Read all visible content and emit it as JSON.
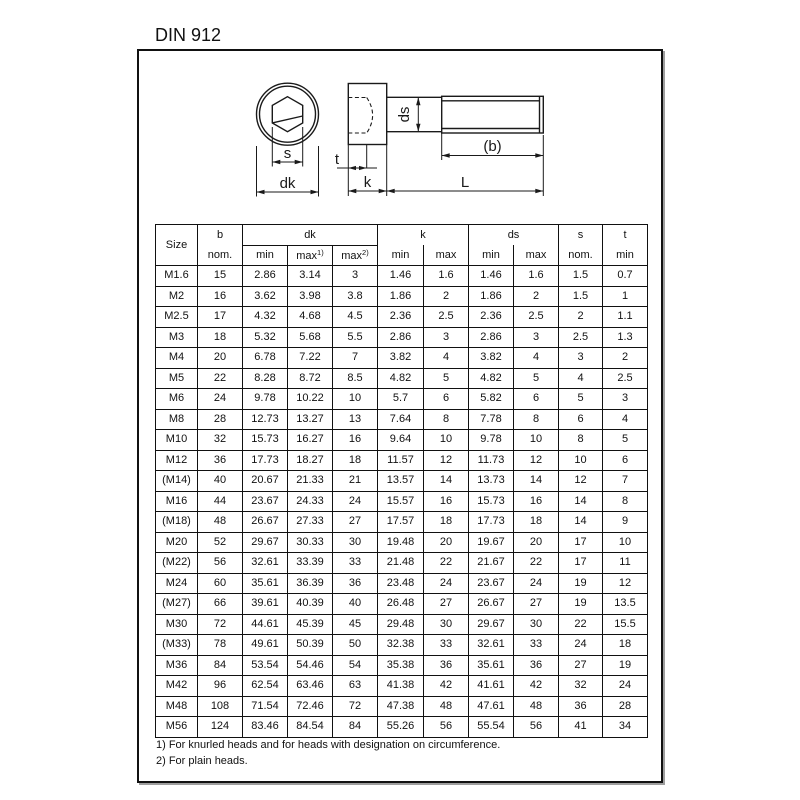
{
  "page": {
    "title": "DIN 912"
  },
  "drawing": {
    "labels": {
      "s": "s",
      "dk": "dk",
      "t": "t",
      "k": "k",
      "ds": "ds",
      "b": "(b)",
      "L": "L"
    }
  },
  "table": {
    "header": {
      "size": "Size",
      "b": "b",
      "b_sub": "nom.",
      "dk": "dk",
      "k": "k",
      "ds": "ds",
      "s": "s",
      "s_sub": "nom.",
      "t": "t",
      "t_sub": "min",
      "min": "min",
      "max": "max",
      "sup1": "1)",
      "sup2": "2)"
    },
    "columns": [
      "Size",
      "b nom.",
      "dk min",
      "dk max1)",
      "dk max2)",
      "k min",
      "k max",
      "ds min",
      "ds max",
      "s nom.",
      "t min"
    ],
    "rows": [
      [
        "M1.6",
        "15",
        "2.86",
        "3.14",
        "3",
        "1.46",
        "1.6",
        "1.46",
        "1.6",
        "1.5",
        "0.7"
      ],
      [
        "M2",
        "16",
        "3.62",
        "3.98",
        "3.8",
        "1.86",
        "2",
        "1.86",
        "2",
        "1.5",
        "1"
      ],
      [
        "M2.5",
        "17",
        "4.32",
        "4.68",
        "4.5",
        "2.36",
        "2.5",
        "2.36",
        "2.5",
        "2",
        "1.1"
      ],
      [
        "M3",
        "18",
        "5.32",
        "5.68",
        "5.5",
        "2.86",
        "3",
        "2.86",
        "3",
        "2.5",
        "1.3"
      ],
      [
        "M4",
        "20",
        "6.78",
        "7.22",
        "7",
        "3.82",
        "4",
        "3.82",
        "4",
        "3",
        "2"
      ],
      [
        "M5",
        "22",
        "8.28",
        "8.72",
        "8.5",
        "4.82",
        "5",
        "4.82",
        "5",
        "4",
        "2.5"
      ],
      [
        "M6",
        "24",
        "9.78",
        "10.22",
        "10",
        "5.7",
        "6",
        "5.82",
        "6",
        "5",
        "3"
      ],
      [
        "M8",
        "28",
        "12.73",
        "13.27",
        "13",
        "7.64",
        "8",
        "7.78",
        "8",
        "6",
        "4"
      ],
      [
        "M10",
        "32",
        "15.73",
        "16.27",
        "16",
        "9.64",
        "10",
        "9.78",
        "10",
        "8",
        "5"
      ],
      [
        "M12",
        "36",
        "17.73",
        "18.27",
        "18",
        "11.57",
        "12",
        "11.73",
        "12",
        "10",
        "6"
      ],
      [
        "(M14)",
        "40",
        "20.67",
        "21.33",
        "21",
        "13.57",
        "14",
        "13.73",
        "14",
        "12",
        "7"
      ],
      [
        "M16",
        "44",
        "23.67",
        "24.33",
        "24",
        "15.57",
        "16",
        "15.73",
        "16",
        "14",
        "8"
      ],
      [
        "(M18)",
        "48",
        "26.67",
        "27.33",
        "27",
        "17.57",
        "18",
        "17.73",
        "18",
        "14",
        "9"
      ],
      [
        "M20",
        "52",
        "29.67",
        "30.33",
        "30",
        "19.48",
        "20",
        "19.67",
        "20",
        "17",
        "10"
      ],
      [
        "(M22)",
        "56",
        "32.61",
        "33.39",
        "33",
        "21.48",
        "22",
        "21.67",
        "22",
        "17",
        "11"
      ],
      [
        "M24",
        "60",
        "35.61",
        "36.39",
        "36",
        "23.48",
        "24",
        "23.67",
        "24",
        "19",
        "12"
      ],
      [
        "(M27)",
        "66",
        "39.61",
        "40.39",
        "40",
        "26.48",
        "27",
        "26.67",
        "27",
        "19",
        "13.5"
      ],
      [
        "M30",
        "72",
        "44.61",
        "45.39",
        "45",
        "29.48",
        "30",
        "29.67",
        "30",
        "22",
        "15.5"
      ],
      [
        "(M33)",
        "78",
        "49.61",
        "50.39",
        "50",
        "32.38",
        "33",
        "32.61",
        "33",
        "24",
        "18"
      ],
      [
        "M36",
        "84",
        "53.54",
        "54.46",
        "54",
        "35.38",
        "36",
        "35.61",
        "36",
        "27",
        "19"
      ],
      [
        "M42",
        "96",
        "62.54",
        "63.46",
        "63",
        "41.38",
        "42",
        "41.61",
        "42",
        "32",
        "24"
      ],
      [
        "M48",
        "108",
        "71.54",
        "72.46",
        "72",
        "47.38",
        "48",
        "47.61",
        "48",
        "36",
        "28"
      ],
      [
        "M56",
        "124",
        "83.46",
        "84.54",
        "84",
        "55.26",
        "56",
        "55.54",
        "56",
        "41",
        "34"
      ]
    ]
  },
  "footnotes": [
    "1) For knurled heads and for heads with designation on circumference.",
    "2) For plain heads."
  ]
}
